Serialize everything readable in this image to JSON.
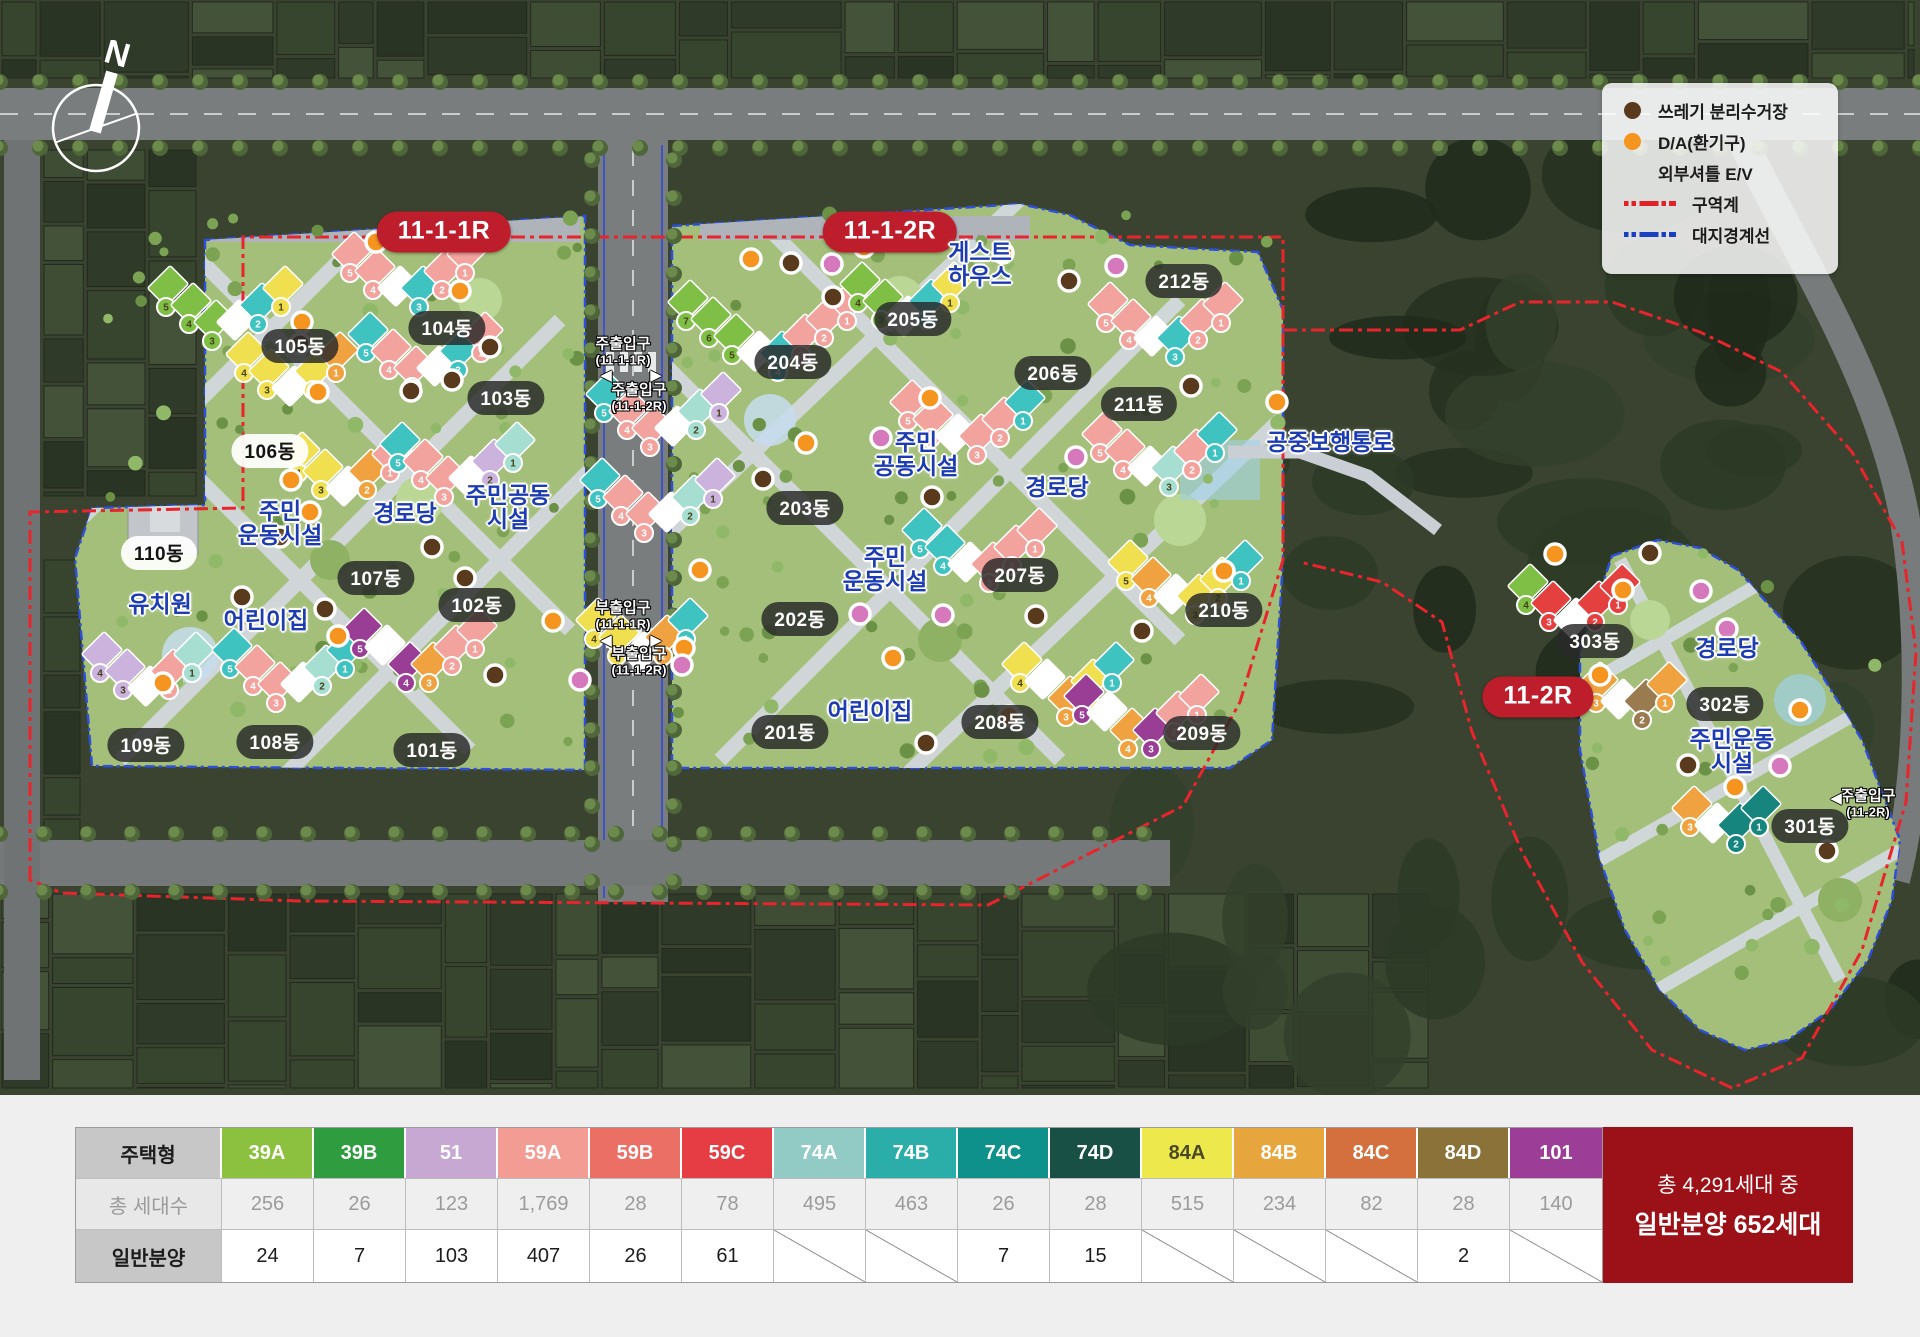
{
  "compass": {
    "label": "N"
  },
  "legend": {
    "items": [
      {
        "icon": "dot-brown",
        "color": "#5A3A1C",
        "label": "쓰레기 분리수거장"
      },
      {
        "icon": "dot-orange",
        "color": "#F5941F",
        "label": "D/A(환기구)"
      },
      {
        "icon": "none",
        "color": "",
        "label": "외부셔틀 E/V"
      },
      {
        "icon": "line-red",
        "color": "#E02128",
        "label": "구역계"
      },
      {
        "icon": "line-blue",
        "color": "#1B3FC0",
        "label": "대지경계선"
      }
    ]
  },
  "map": {
    "zones": [
      {
        "label": "11-1-1R",
        "x": 444,
        "y": 232
      },
      {
        "label": "11-1-2R",
        "x": 890,
        "y": 232
      },
      {
        "label": "11-2R",
        "x": 1538,
        "y": 697
      }
    ],
    "building_labels": [
      {
        "label": "105동",
        "x": 300,
        "y": 346,
        "light": false
      },
      {
        "label": "104동",
        "x": 447,
        "y": 328,
        "light": false
      },
      {
        "label": "103동",
        "x": 506,
        "y": 398,
        "light": false
      },
      {
        "label": "106동",
        "x": 270,
        "y": 451,
        "light": true
      },
      {
        "label": "110동",
        "x": 159,
        "y": 553,
        "light": true
      },
      {
        "label": "107동",
        "x": 376,
        "y": 578,
        "light": false
      },
      {
        "label": "102동",
        "x": 477,
        "y": 605,
        "light": false
      },
      {
        "label": "109동",
        "x": 146,
        "y": 745,
        "light": false
      },
      {
        "label": "108동",
        "x": 275,
        "y": 742,
        "light": false
      },
      {
        "label": "101동",
        "x": 432,
        "y": 750,
        "light": false
      },
      {
        "label": "204동",
        "x": 793,
        "y": 362,
        "light": false
      },
      {
        "label": "205동",
        "x": 913,
        "y": 319,
        "light": false
      },
      {
        "label": "206동",
        "x": 1053,
        "y": 373,
        "light": false
      },
      {
        "label": "212동",
        "x": 1184,
        "y": 281,
        "light": false
      },
      {
        "label": "211동",
        "x": 1139,
        "y": 404,
        "light": false
      },
      {
        "label": "203동",
        "x": 805,
        "y": 508,
        "light": false
      },
      {
        "label": "207동",
        "x": 1020,
        "y": 575,
        "light": false
      },
      {
        "label": "202동",
        "x": 800,
        "y": 619,
        "light": false
      },
      {
        "label": "201동",
        "x": 790,
        "y": 732,
        "light": false
      },
      {
        "label": "208동",
        "x": 1000,
        "y": 722,
        "light": false
      },
      {
        "label": "209동",
        "x": 1202,
        "y": 733,
        "light": false
      },
      {
        "label": "210동",
        "x": 1224,
        "y": 610,
        "light": false
      },
      {
        "label": "303동",
        "x": 1595,
        "y": 641,
        "light": false
      },
      {
        "label": "302동",
        "x": 1725,
        "y": 704,
        "light": false
      },
      {
        "label": "301동",
        "x": 1810,
        "y": 826,
        "light": false
      }
    ],
    "facility_labels": [
      {
        "lines": [
          "주민",
          "운동시설"
        ],
        "x": 280,
        "y": 524
      },
      {
        "lines": [
          "경로당"
        ],
        "x": 405,
        "y": 514
      },
      {
        "lines": [
          "주민공동",
          "시설"
        ],
        "x": 508,
        "y": 508
      },
      {
        "lines": [
          "유치원"
        ],
        "x": 160,
        "y": 605
      },
      {
        "lines": [
          "어린이집"
        ],
        "x": 266,
        "y": 621
      },
      {
        "lines": [
          "게스트",
          "하우스"
        ],
        "x": 980,
        "y": 265
      },
      {
        "lines": [
          "주민",
          "공동시설"
        ],
        "x": 916,
        "y": 455
      },
      {
        "lines": [
          "경로당"
        ],
        "x": 1057,
        "y": 488
      },
      {
        "lines": [
          "주민",
          "운동시설"
        ],
        "x": 885,
        "y": 570
      },
      {
        "lines": [
          "어린이집"
        ],
        "x": 870,
        "y": 712
      },
      {
        "lines": [
          "공중보행통로"
        ],
        "x": 1330,
        "y": 443
      },
      {
        "lines": [
          "경로당"
        ],
        "x": 1727,
        "y": 649
      },
      {
        "lines": [
          "주민운동",
          "시설"
        ],
        "x": 1732,
        "y": 752
      }
    ],
    "entrance_labels": [
      {
        "title": "주출입구",
        "sub": "(11-1-1R)",
        "x": 623,
        "y": 352
      },
      {
        "title": "주출입구",
        "sub": "(11-1-2R)",
        "x": 639,
        "y": 398
      },
      {
        "title": "부출입구",
        "sub": "(11-1-1R)",
        "x": 623,
        "y": 616
      },
      {
        "title": "부출입구",
        "sub": "(11-1-2R)",
        "x": 639,
        "y": 662
      },
      {
        "title": "주출입구",
        "sub": "(11-2R)",
        "x": 1868,
        "y": 804
      }
    ],
    "entrance_arrows": [
      {
        "glyph": "◀",
        "x": 606,
        "y": 375
      },
      {
        "glyph": "▶",
        "x": 656,
        "y": 375
      },
      {
        "glyph": "◀",
        "x": 606,
        "y": 640
      },
      {
        "glyph": "▶",
        "x": 656,
        "y": 640
      },
      {
        "glyph": "◀",
        "x": 1836,
        "y": 798
      }
    ],
    "marker_colors": {
      "orange": "#F5941F",
      "brown": "#5A3A1C",
      "pink": "#D579BC"
    },
    "markers": {
      "orange": [
        [
          376,
          242
        ],
        [
          460,
          291
        ],
        [
          302,
          322
        ],
        [
          318,
          392
        ],
        [
          291,
          480
        ],
        [
          310,
          512
        ],
        [
          163,
          683
        ],
        [
          338,
          636
        ],
        [
          553,
          621
        ],
        [
          751,
          259
        ],
        [
          864,
          247
        ],
        [
          1003,
          253
        ],
        [
          930,
          398
        ],
        [
          806,
          443
        ],
        [
          700,
          570
        ],
        [
          684,
          648
        ],
        [
          1009,
          716
        ],
        [
          893,
          658
        ],
        [
          1277,
          402
        ],
        [
          1224,
          571
        ],
        [
          1555,
          554
        ],
        [
          1623,
          590
        ],
        [
          1600,
          675
        ],
        [
          1800,
          710
        ],
        [
          1735,
          787
        ]
      ],
      "brown": [
        [
          300,
          344
        ],
        [
          452,
          380
        ],
        [
          411,
          391
        ],
        [
          490,
          347
        ],
        [
          280,
          537
        ],
        [
          242,
          597
        ],
        [
          325,
          609
        ],
        [
          432,
          547
        ],
        [
          465,
          578
        ],
        [
          495,
          675
        ],
        [
          791,
          263
        ],
        [
          833,
          297
        ],
        [
          1069,
          281
        ],
        [
          763,
          479
        ],
        [
          932,
          497
        ],
        [
          1191,
          386
        ],
        [
          1036,
          616
        ],
        [
          926,
          743
        ],
        [
          1142,
          631
        ],
        [
          1650,
          553
        ],
        [
          1688,
          765
        ],
        [
          1827,
          851
        ]
      ],
      "pink": [
        [
          580,
          680
        ],
        [
          832,
          264
        ],
        [
          1116,
          266
        ],
        [
          881,
          438
        ],
        [
          860,
          614
        ],
        [
          943,
          615
        ],
        [
          682,
          665
        ],
        [
          1076,
          457
        ],
        [
          1701,
          591
        ],
        [
          1727,
          629
        ],
        [
          1780,
          766
        ]
      ]
    },
    "building_palette": {
      "P": "#F2A39E",
      "Y": "#F0DF4F",
      "T": "#3FC3C0",
      "G": "#7FBF45",
      "L": "#CBB3DD",
      "M": "#A6DFD2",
      "O": "#EFA23F",
      "U": "#993D95",
      "R": "#E4403F",
      "W": "#FFFFFF",
      "D": "#15857D",
      "B": "#9A7B4F"
    },
    "building_shapes": [
      {
        "x": 168,
        "y": 286,
        "segs": "GGGWTY"
      },
      {
        "x": 352,
        "y": 252,
        "segs": "PPWTPP"
      },
      {
        "x": 368,
        "y": 332,
        "segs": "TPPWTP"
      },
      {
        "x": 246,
        "y": 352,
        "segs": "YYWYO"
      },
      {
        "x": 300,
        "y": 452,
        "segs": "YYWOP"
      },
      {
        "x": 400,
        "y": 442,
        "segs": "TPPWLM"
      },
      {
        "x": 102,
        "y": 652,
        "segs": "LLWPM"
      },
      {
        "x": 232,
        "y": 648,
        "segs": "TPPWMT"
      },
      {
        "x": 362,
        "y": 628,
        "segs": "UWUOPP"
      },
      {
        "x": 688,
        "y": 300,
        "segs": "GGGWTPPP"
      },
      {
        "x": 860,
        "y": 282,
        "segs": "GGWTY"
      },
      {
        "x": 910,
        "y": 400,
        "segs": "PPWPPT"
      },
      {
        "x": 606,
        "y": 392,
        "segs": "TPPWML"
      },
      {
        "x": 600,
        "y": 478,
        "segs": "TPPWML"
      },
      {
        "x": 596,
        "y": 618,
        "segs": "YYWOT"
      },
      {
        "x": 1108,
        "y": 302,
        "segs": "PPWTPP"
      },
      {
        "x": 1102,
        "y": 432,
        "segs": "PPWMPT"
      },
      {
        "x": 922,
        "y": 528,
        "segs": "TTWPPP"
      },
      {
        "x": 1128,
        "y": 560,
        "segs": "YOWYYT"
      },
      {
        "x": 1022,
        "y": 662,
        "segs": "YWOYT"
      },
      {
        "x": 1084,
        "y": 694,
        "segs": "UWOUPP"
      },
      {
        "x": 1528,
        "y": 584,
        "segs": "GRWRR"
      },
      {
        "x": 1598,
        "y": 682,
        "segs": "OWBO"
      },
      {
        "x": 1692,
        "y": 806,
        "segs": "OWDD"
      }
    ]
  },
  "table": {
    "row_headers": [
      "주택형",
      "총 세대수",
      "일반분양"
    ],
    "columns": [
      {
        "type": "39A",
        "color": "#8CC140",
        "dark_text": false,
        "total": "256",
        "sale": "24"
      },
      {
        "type": "39B",
        "color": "#2E9C3F",
        "dark_text": false,
        "total": "26",
        "sale": "7"
      },
      {
        "type": "51",
        "color": "#C6A8D2",
        "dark_text": false,
        "total": "123",
        "sale": "103"
      },
      {
        "type": "59A",
        "color": "#F29C94",
        "dark_text": false,
        "total": "1,769",
        "sale": "407"
      },
      {
        "type": "59B",
        "color": "#EC6F66",
        "dark_text": false,
        "total": "28",
        "sale": "26"
      },
      {
        "type": "59C",
        "color": "#E63C43",
        "dark_text": false,
        "total": "78",
        "sale": "61"
      },
      {
        "type": "74A",
        "color": "#92CBC5",
        "dark_text": false,
        "total": "495",
        "sale": ""
      },
      {
        "type": "74B",
        "color": "#2BADA9",
        "dark_text": false,
        "total": "463",
        "sale": ""
      },
      {
        "type": "74C",
        "color": "#0E918A",
        "dark_text": false,
        "total": "26",
        "sale": "7"
      },
      {
        "type": "74D",
        "color": "#185045",
        "dark_text": false,
        "total": "28",
        "sale": "15"
      },
      {
        "type": "84A",
        "color": "#EDE94C",
        "dark_text": true,
        "total": "515",
        "sale": ""
      },
      {
        "type": "84B",
        "color": "#E6A63D",
        "dark_text": false,
        "total": "234",
        "sale": ""
      },
      {
        "type": "84C",
        "color": "#D3703D",
        "dark_text": false,
        "total": "82",
        "sale": ""
      },
      {
        "type": "84D",
        "color": "#8A7238",
        "dark_text": false,
        "total": "28",
        "sale": "2"
      },
      {
        "type": "101",
        "color": "#9C3E98",
        "dark_text": false,
        "total": "140",
        "sale": ""
      }
    ]
  },
  "summary": {
    "line1": "총 4,291세대 중",
    "line2": "일반분양 652세대"
  }
}
